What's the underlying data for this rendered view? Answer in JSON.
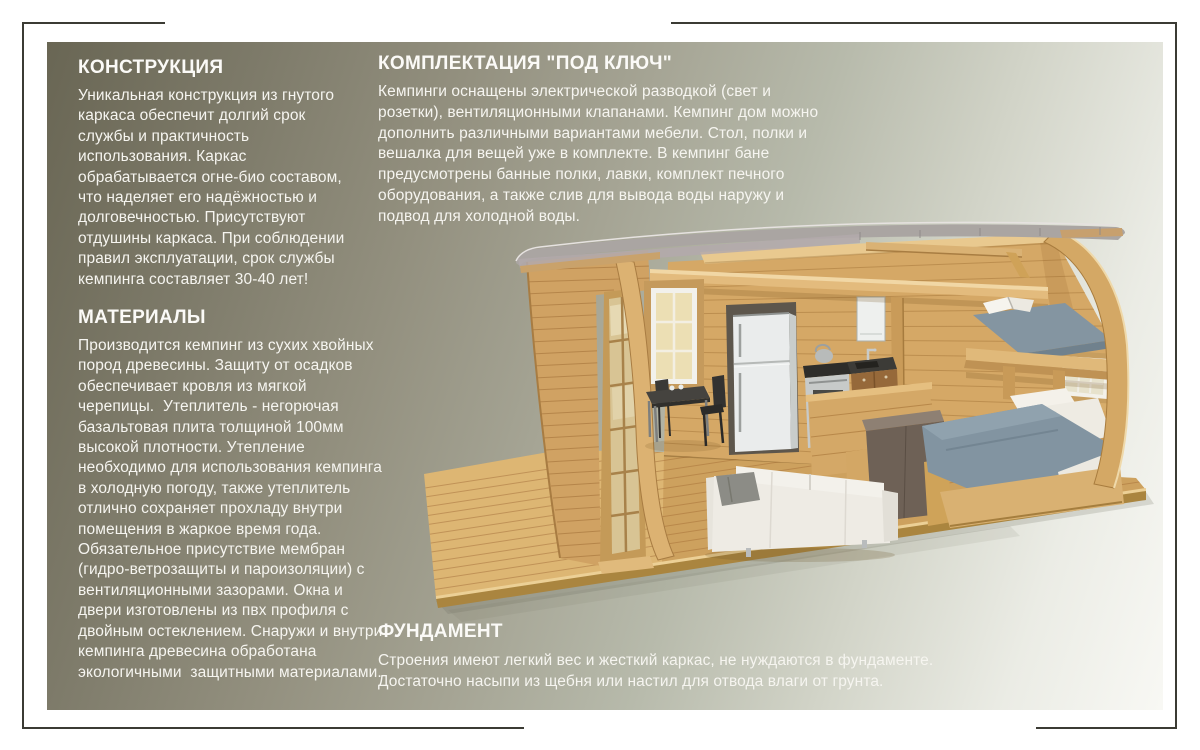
{
  "page": {
    "background": "#ffffff",
    "frame_color": "#3b3b34",
    "panel_gradient": [
      "#696654",
      "#a5a494",
      "#f8f8f4"
    ],
    "text_color": "#f6f5f0"
  },
  "sections": {
    "construction": {
      "title": "КОНСТРУКЦИЯ",
      "body": "Уникальная конструкция из гнутого\nкаркаса обеспечит долгий срок\nслужбы и практичность\nиспользования. Каркас\nобрабатывается огне-био составом,\nчто наделяет его надёжностью и\nдолговечностью. Присутствуют\nотдушины каркаса. При соблюдении\nправил эксплуатации, срок службы\nкемпинга составляет 30-40 лет!"
    },
    "materials": {
      "title": "МАТЕРИАЛЫ",
      "body": "Производится кемпинг из сухих хвойных\nпород древесины. Защиту от осадков\nобеспечивает кровля из мягкой\nчерепицы.  Утеплитель - негорючая\nбазальтовая плита толщиной 100мм\nвысокой плотности. Утепление\nнеобходимо для использования кемпинга\nв холодную погоду, также утеплитель\nотлично сохраняет прохладу внутри\nпомещения в жаркое время года.\nОбязательное присутствие мембран\n(гидро-ветрозащиты и пароизоляции) с\nвентиляционными зазорами. Окна и\nдвери изготовлены из пвх профиля с\nдвойным остеклением. Снаружи и внутри\nкемпинга древесина обработана\nэкологичными  защитными материалами."
    },
    "turnkey": {
      "title": "КОМПЛЕКТАЦИЯ \"ПОД КЛЮЧ\"",
      "body": "Кемпинги оснащены электрической разводкой (свет и\nрозетки), вентиляционными клапанами. Кемпинг дом можно\nдополнить различными вариантами мебели. Стол, полки и\nвешалка для вещей уже в комплекте. В кемпинг бане\nпредусмотрены банные полки, лавки, комплект печного\nоборудования, а также слив для вывода воды наружу и\nподвод для холодной воды."
    },
    "foundation": {
      "title": "ФУНДАМЕНТ",
      "body": "Строения имеют легкий вес и жесткий каркас, не нуждаются в фундаменте.\nДостаточно насыпи из щебня или настил для отвода влаги от грунта."
    }
  },
  "illustration": {
    "alt": "3D-разрез деревянного кемпинг-дома с арочной крышей: терраса, кухня с холодильником и плитой, стол со стульями, диван, двуспальная кровать и спальный лофт",
    "palette": {
      "wood": "#d5a866",
      "deck": "#ddb673",
      "roof": "#a7a3a0",
      "textile": "#8294a1",
      "sofa": "#eeebe4"
    }
  }
}
